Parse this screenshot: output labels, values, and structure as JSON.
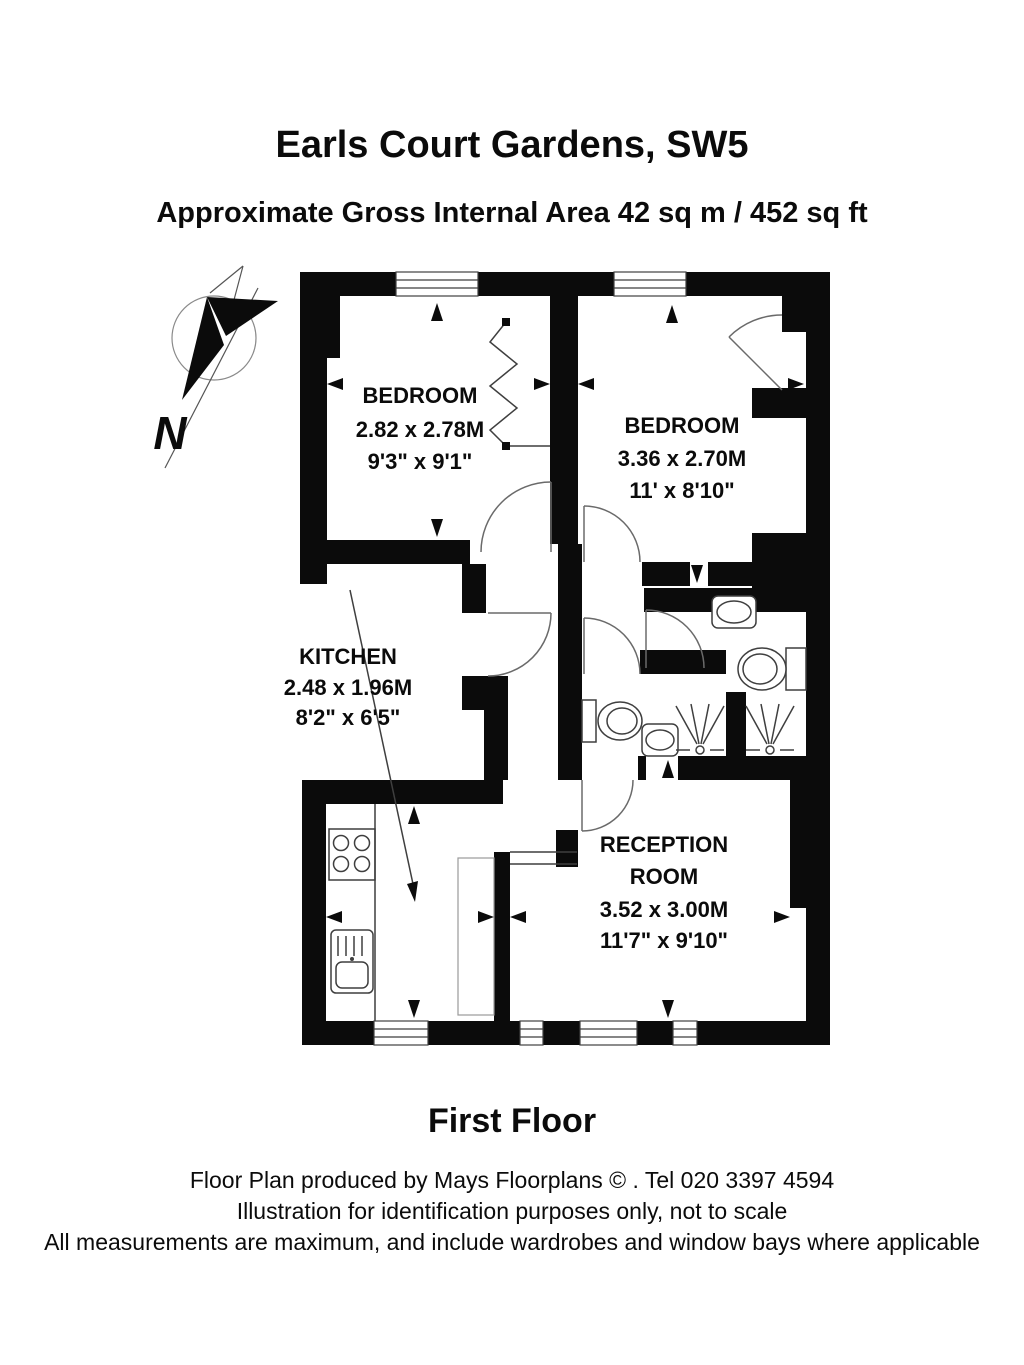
{
  "title": "Earls Court Gardens, SW5",
  "subtitle": "Approximate Gross Internal Area 42 sq m  /  452 sq ft",
  "compass": {
    "north_label": "N"
  },
  "rooms": {
    "bedroom1": {
      "name": "BEDROOM",
      "size_metric": "2.82 x 2.78M",
      "size_imperial": "9'3\" x 9'1\""
    },
    "bedroom2": {
      "name": "BEDROOM",
      "size_metric": "3.36 x 2.70M",
      "size_imperial": "11' x 8'10\""
    },
    "kitchen": {
      "name": "KITCHEN",
      "size_metric": "2.48 x 1.96M",
      "size_imperial": "8'2\" x 6'5\""
    },
    "reception": {
      "name_line1": "RECEPTION",
      "name_line2": "ROOM",
      "size_metric": "3.52 x 3.00M",
      "size_imperial": "11'7\" x 9'10\""
    }
  },
  "floor_label": "First Floor",
  "footer": {
    "line1": "Floor Plan produced by Mays Floorplans  © . Tel 020 3397 4594",
    "line2": "Illustration for identification purposes only, not to scale",
    "line3": "All measurements are maximum, and include wardrobes and window bays where applicable"
  }
}
